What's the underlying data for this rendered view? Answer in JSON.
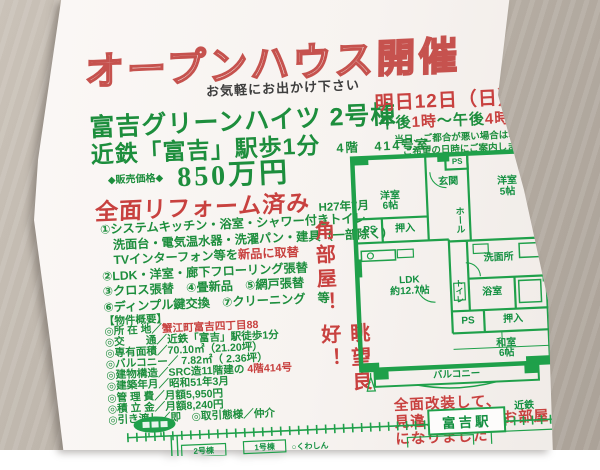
{
  "colors": {
    "green": "#1d8e3d",
    "red": "#c8413f",
    "plan_green": "#1fa04a",
    "paper": "#f8f5f2",
    "desk": "#b7afa5"
  },
  "flyer": {
    "title": "オープンハウス開催",
    "tagline": "お気軽にお出かけ下さい",
    "property_name": "富吉グリーンハイツ 2号棟",
    "access": "近鉄「富吉」駅歩1分",
    "floor_room": "4階　414号室",
    "price_label": "◆販売価格◆",
    "price": "850万円",
    "renovation_headline": "全面リフォーム済み",
    "renovation_date": "H27年7月",
    "renovation_items": [
      {
        "pre": "①システムキッチン・浴室・シャワー付きトイレ",
        "red": ""
      },
      {
        "pre": "　洗面台・電気温水器・洗濯パン・建具（一部除く）",
        "red": ""
      },
      {
        "pre": "　TVインターフォン等を",
        "red": "新品に取替"
      },
      {
        "pre": "②LDK・洋室・廊下フローリング張替",
        "red": ""
      },
      {
        "pre": "③クロス張替　④畳新品　⑤網戸張替",
        "red": ""
      },
      {
        "pre": "⑥ディンプル鍵交換　⑦クリーニング　等",
        "red": ""
      }
    ],
    "event": {
      "date": "明日12日（日）",
      "time_pre": "午後",
      "time_red1": "1時",
      "time_mid": "～午後",
      "time_red2": "4時",
      "note1": "当日、ご都合が悪い場合は、",
      "note2": "ご希望の日時にご案内します"
    },
    "selling_points": {
      "corner": "角部屋！",
      "view": "眺望良好！"
    },
    "overview_header": "【物件概要】",
    "overview_rows": [
      {
        "pre": "◎所 在 地／",
        "red": "蟹江町富吉四丁目88",
        "post": ""
      },
      {
        "pre": "◎交　　通／近鉄「富吉」駅徒歩1分",
        "red": "",
        "post": ""
      },
      {
        "pre": "◎専有面積／70.10㎡（21.20坪）",
        "red": "",
        "post": ""
      },
      {
        "pre": "◎バルコニー／ 7.82㎡（ 2.36坪）",
        "red": "",
        "post": ""
      },
      {
        "pre": "◎建物構造／SRC造11階建の ",
        "red": "4階414号",
        "post": ""
      },
      {
        "pre": "◎建築年月／昭和51年3月",
        "red": "",
        "post": ""
      },
      {
        "pre": "◎管 理 費／月額5,950円",
        "red": "",
        "post": ""
      },
      {
        "pre": "◎積 立 金／月額8,240円",
        "red": "",
        "post": ""
      },
      {
        "pre": "◎引き渡し／即　◎取引態様／仲介",
        "red": "",
        "post": ""
      }
    ],
    "closing_note": {
      "line1": "全面改装して、",
      "line2": "見違えるようなお部屋",
      "line3": "になりました"
    },
    "floorplan": {
      "room_w1": "洋室",
      "room_w1_size": "6帖",
      "entrance": "玄関",
      "hall": "ホール",
      "room_w2": "洋室",
      "room_w2_size": "5帖",
      "ps": "PS",
      "oshiire": "押入",
      "washroom": "洗面所",
      "bath": "浴室",
      "toilet": "トイレ",
      "ldk": "LDK",
      "ldk_size": "約12.7帖",
      "washitsu": "和室",
      "washitsu_size": "6帖",
      "balcony": "バルコニー"
    },
    "map": {
      "line_label": "近鉄",
      "station": "富吉駅",
      "building2": "2号棟",
      "building1": "1号棟",
      "landmark": "○くわしん"
    }
  }
}
